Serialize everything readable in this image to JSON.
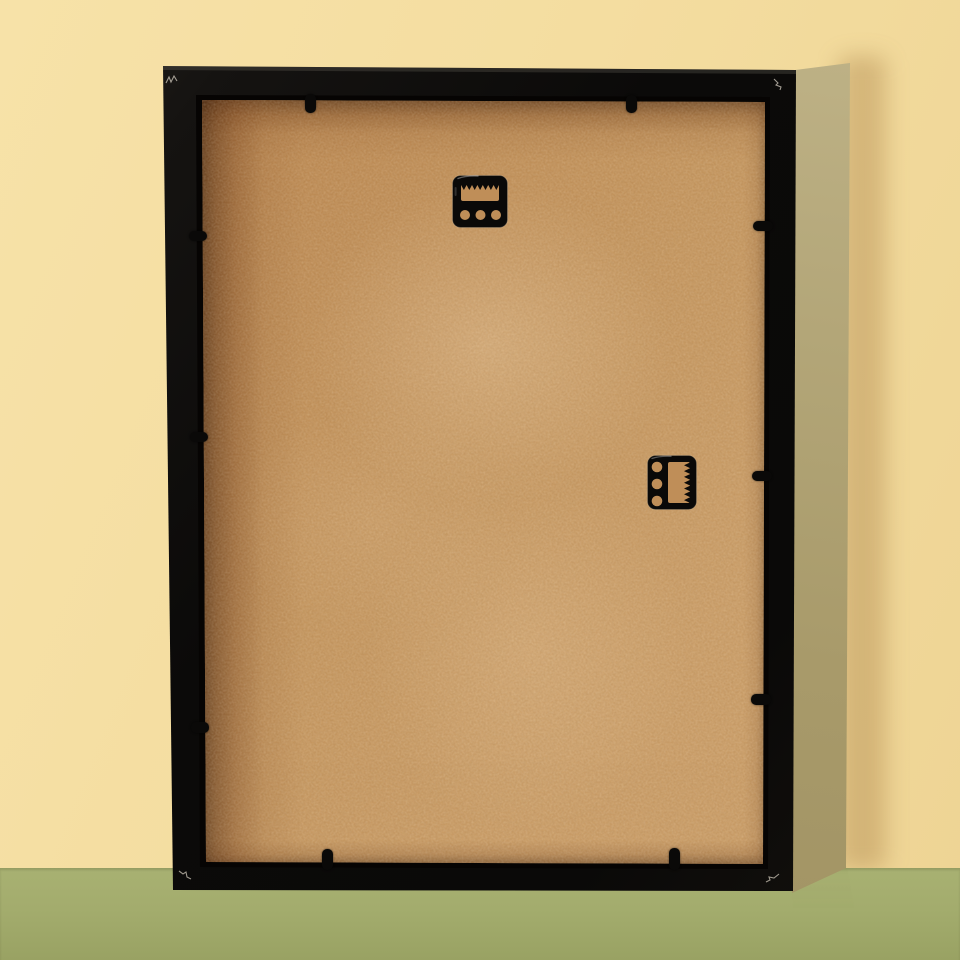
{
  "image_type": "product-photo",
  "subject": "Back view of a black picture frame standing upright on a glossy green floor against a pale yellow wall",
  "colors": {
    "wall": "#f4dda0",
    "wall_light": "#f7e2a8",
    "wall_dark": "#eed494",
    "floor": "#a8b172",
    "floor_dark": "#99a263",
    "frame_black": "#0b0a09",
    "frame_side_light": "#c0b489",
    "frame_side_dark": "#9f9162",
    "backing_tan": "#c4965f",
    "backing_shadow_brown": "#6f3c16",
    "hardware_black": "#0a0908",
    "hardware_opening": "#bf8e58"
  },
  "objects": {
    "frame": {
      "label": "picture frame, rear side",
      "finish": "matte black wood"
    },
    "side_panel": {
      "label": "right side panel of frame box"
    },
    "backing_board": {
      "label": "tan MDF backing board"
    },
    "hangers": [
      {
        "label": "sawtooth hanger, top center, horizontal",
        "holes": 3,
        "teeth": 7
      },
      {
        "label": "sawtooth hanger, right of center, vertical",
        "holes": 3,
        "teeth": 7
      }
    ],
    "retainer_tabs": {
      "label": "black metal retainer tabs around backing edge",
      "count": 10,
      "per_edge": {
        "top": 2,
        "left": 3,
        "right": 3,
        "bottom": 2
      }
    },
    "corner_scratches": {
      "label": "small scuff marks on frame corners",
      "count": 4
    },
    "reflection": {
      "label": "soft reflection of frame on glossy floor"
    },
    "shadow": {
      "label": "soft shadow on wall right of frame"
    }
  }
}
